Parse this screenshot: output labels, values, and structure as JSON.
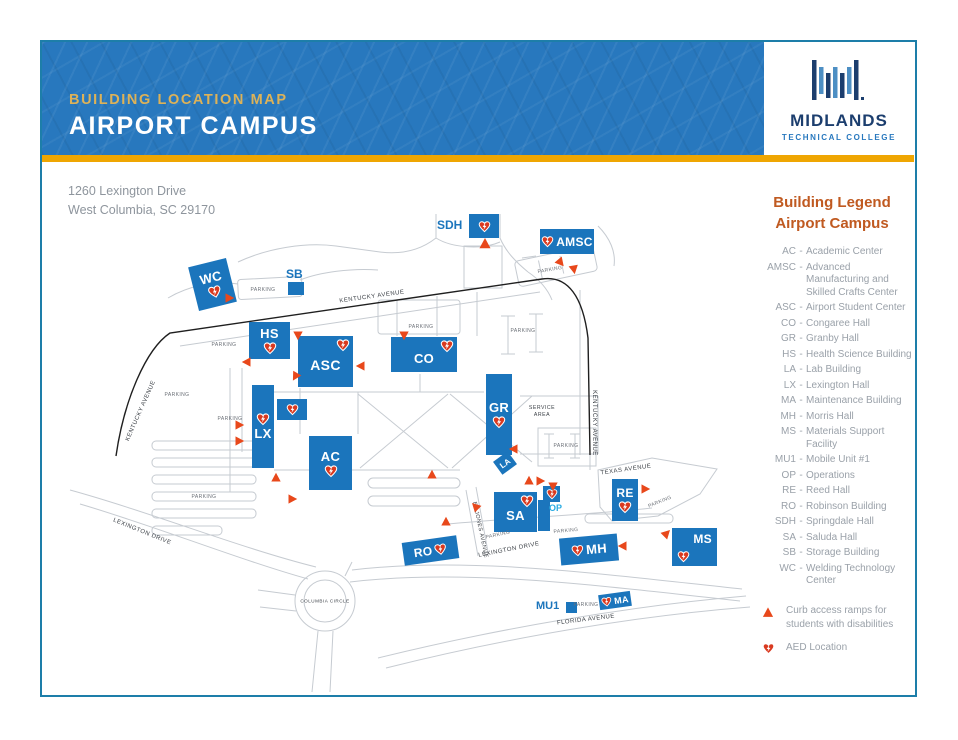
{
  "colors": {
    "header_blue": "#2878BE",
    "gold": "#EFA602",
    "eyebrow_gold": "#DDB258",
    "navy": "#1C3E6E",
    "brand_blue": "#2878BE",
    "building_blue": "#1B75BC",
    "legend_orange": "#C05A21",
    "legend_text_gray": "#9AA1A9",
    "address_gray": "#8E959D",
    "heart_red": "#D93A20",
    "ramp_orange": "#E8481B",
    "op_label_blue": "#29ABE2",
    "border_teal": "#1D7EA9",
    "road_gray": "#C6CBD1",
    "road_black": "#1F1F1F"
  },
  "header": {
    "eyebrow": "BUILDING LOCATION MAP",
    "title": "AIRPORT CAMPUS"
  },
  "brand": {
    "name": "MIDLANDS",
    "tagline": "TECHNICAL COLLEGE"
  },
  "address": {
    "line1": "1260 Lexington Drive",
    "line2": "West Columbia, SC 29170"
  },
  "legend": {
    "title_line1": "Building Legend",
    "title_line2": "Airport Campus",
    "separator": "-",
    "entries": [
      {
        "abbr": "AC",
        "name": "Academic Center"
      },
      {
        "abbr": "AMSC",
        "name": "Advanced Manufacturing and Skilled Crafts Center"
      },
      {
        "abbr": "ASC",
        "name": "Airport Student Center"
      },
      {
        "abbr": "CO",
        "name": "Congaree Hall"
      },
      {
        "abbr": "GR",
        "name": "Granby Hall"
      },
      {
        "abbr": "HS",
        "name": "Health Science Building"
      },
      {
        "abbr": "LA",
        "name": "Lab Building"
      },
      {
        "abbr": "LX",
        "name": "Lexington Hall"
      },
      {
        "abbr": "MA",
        "name": "Maintenance Building"
      },
      {
        "abbr": "MH",
        "name": "Morris Hall"
      },
      {
        "abbr": "MS",
        "name": "Materials Support Facility"
      },
      {
        "abbr": "MU1",
        "name": "Mobile Unit #1"
      },
      {
        "abbr": "OP",
        "name": "Operations"
      },
      {
        "abbr": "RE",
        "name": "Reed Hall"
      },
      {
        "abbr": "RO",
        "name": "Robinson Building"
      },
      {
        "abbr": "SDH",
        "name": "Springdale Hall"
      },
      {
        "abbr": "SA",
        "name": "Saluda Hall"
      },
      {
        "abbr": "SB",
        "name": "Storage Building"
      },
      {
        "abbr": "WC",
        "name": "Welding Technology Center"
      }
    ],
    "markers": [
      {
        "icon": "ramp-triangle",
        "label": "Curb access ramps for students with disabilities"
      },
      {
        "icon": "aed-heart",
        "label": "AED Location"
      }
    ]
  },
  "map": {
    "buildings": [
      {
        "id": "WC",
        "label": "WC",
        "x": 193,
        "y": 262,
        "w": 39,
        "h": 45,
        "rot": -14,
        "fs": 13,
        "layout": "v-lh"
      },
      {
        "id": "SB",
        "label": "",
        "x": 288,
        "y": 282,
        "w": 16,
        "h": 13,
        "rot": 0,
        "layout": "none"
      },
      {
        "id": "SDH",
        "label": "",
        "x": 469,
        "y": 214,
        "w": 30,
        "h": 24,
        "rot": 0,
        "hs": 13,
        "layout": "heart"
      },
      {
        "id": "AMSC",
        "label": "AMSC",
        "x": 540,
        "y": 229,
        "w": 54,
        "h": 25,
        "rot": 0,
        "fs": 12,
        "hs": 13,
        "layout": "inline-hl"
      },
      {
        "id": "HS",
        "label": "HS",
        "x": 249,
        "y": 322,
        "w": 41,
        "h": 37,
        "rot": 0,
        "fs": 13,
        "layout": "v-lh"
      },
      {
        "id": "ASC",
        "label": "ASC",
        "x": 298,
        "y": 336,
        "w": 55,
        "h": 51,
        "rot": 0,
        "fs": 14,
        "layout": "corner-tr"
      },
      {
        "id": "CO",
        "label": "CO",
        "x": 391,
        "y": 337,
        "w": 66,
        "h": 35,
        "rot": 0,
        "fs": 13,
        "layout": "corner-tr"
      },
      {
        "id": "GR",
        "label": "GR",
        "x": 486,
        "y": 374,
        "w": 26,
        "h": 81,
        "rot": 0,
        "fs": 13,
        "layout": "v-lh"
      },
      {
        "id": "LX",
        "label": "LX",
        "x": 252,
        "y": 385,
        "w": 22,
        "h": 83,
        "rot": 0,
        "fs": 13,
        "layout": "v-hl"
      },
      {
        "id": "LXA",
        "label": "",
        "x": 277,
        "y": 399,
        "w": 30,
        "h": 21,
        "rot": 0,
        "hs": 13,
        "layout": "heart"
      },
      {
        "id": "AC",
        "label": "AC",
        "x": 309,
        "y": 436,
        "w": 43,
        "h": 54,
        "rot": 0,
        "fs": 13,
        "layout": "v-lh"
      },
      {
        "id": "LA",
        "label": "LA",
        "x": 496,
        "y": 455,
        "w": 18,
        "h": 16,
        "rot": -36,
        "fs": 8,
        "layout": "label"
      },
      {
        "id": "SA",
        "label": "SA",
        "x": 494,
        "y": 492,
        "w": 43,
        "h": 40,
        "rot": 0,
        "fs": 13,
        "layout": "corner-tr"
      },
      {
        "id": "SAA",
        "label": "",
        "x": 538,
        "y": 500,
        "w": 12,
        "h": 31,
        "rot": 0,
        "layout": "none"
      },
      {
        "id": "OPB",
        "label": "",
        "x": 543,
        "y": 486,
        "w": 17,
        "h": 16,
        "rot": 0,
        "hs": 12,
        "layout": "heart"
      },
      {
        "id": "RE",
        "label": "RE",
        "x": 612,
        "y": 479,
        "w": 26,
        "h": 42,
        "rot": 0,
        "fs": 12,
        "layout": "v-lh"
      },
      {
        "id": "RO",
        "label": "RO",
        "x": 403,
        "y": 539,
        "w": 55,
        "h": 23,
        "rot": -8,
        "fs": 12,
        "hs": 13,
        "layout": "inline-lh"
      },
      {
        "id": "MH",
        "label": "MH",
        "x": 560,
        "y": 536,
        "w": 58,
        "h": 27,
        "rot": -5,
        "fs": 13,
        "hs": 13,
        "layout": "inline-hl"
      },
      {
        "id": "MS",
        "label": "MS",
        "x": 672,
        "y": 528,
        "w": 45,
        "h": 38,
        "rot": 0,
        "fs": 12,
        "hs": 13,
        "layout": "ms"
      },
      {
        "id": "MA",
        "label": "MA",
        "x": 599,
        "y": 593,
        "w": 32,
        "h": 15,
        "rot": -8,
        "fs": 9,
        "hs": 11,
        "layout": "inline-hl"
      },
      {
        "id": "MU1B",
        "label": "",
        "x": 566,
        "y": 602,
        "w": 11,
        "h": 11,
        "rot": 0,
        "layout": "none"
      }
    ],
    "floating_labels": [
      {
        "text": "SB",
        "x": 286,
        "y": 267,
        "fs": 12,
        "color": "#1B75BC"
      },
      {
        "text": "SDH",
        "x": 437,
        "y": 218,
        "fs": 12,
        "color": "#1B75BC"
      },
      {
        "text": "OP",
        "x": 549,
        "y": 503,
        "fs": 9,
        "color": "#29ABE2"
      },
      {
        "text": "MU1",
        "x": 536,
        "y": 600,
        "fs": 11,
        "color": "#1B75BC"
      }
    ],
    "road_labels": [
      {
        "text": "KENTUCKY AVENUE",
        "x": 372,
        "y": 297,
        "rot": -8,
        "fs": 6
      },
      {
        "text": "KENTUCKY AVENUE",
        "x": 141,
        "y": 411,
        "rot": -66,
        "fs": 6
      },
      {
        "text": "KENTUCKY AVENUE",
        "x": 594,
        "y": 423,
        "rot": 90,
        "fs": 6
      },
      {
        "text": "TEXAS AVENUE",
        "x": 626,
        "y": 470,
        "rot": -8,
        "fs": 6
      },
      {
        "text": "EL JONES AVENUE",
        "x": 480,
        "y": 530,
        "rot": 78,
        "fs": 5.5
      },
      {
        "text": "LEXINGTON DRIVE",
        "x": 142,
        "y": 532,
        "rot": 22,
        "fs": 6
      },
      {
        "text": "LEXINGTON DRIVE",
        "x": 509,
        "y": 550,
        "rot": -11,
        "fs": 6
      },
      {
        "text": "COLUMBIA CIRCLE",
        "x": 325,
        "y": 601,
        "rot": 0,
        "fs": 4.6
      },
      {
        "text": "FLORIDA AVENUE",
        "x": 586,
        "y": 620,
        "rot": -7,
        "fs": 6
      },
      {
        "text": "SERVICE",
        "x": 542,
        "y": 408,
        "rot": 0,
        "fs": 5.2
      },
      {
        "text": "AREA",
        "x": 542,
        "y": 415,
        "rot": 0,
        "fs": 5.2
      }
    ],
    "parking_label_text": "PARKING",
    "parking_labels": [
      {
        "x": 263,
        "y": 290,
        "rot": 0
      },
      {
        "x": 224,
        "y": 345,
        "rot": 0
      },
      {
        "x": 177,
        "y": 395,
        "rot": 0
      },
      {
        "x": 230,
        "y": 419,
        "rot": 0
      },
      {
        "x": 204,
        "y": 497,
        "rot": 0
      },
      {
        "x": 421,
        "y": 327,
        "rot": 0
      },
      {
        "x": 523,
        "y": 331,
        "rot": 0
      },
      {
        "x": 550,
        "y": 270,
        "rot": -10
      },
      {
        "x": 566,
        "y": 446,
        "rot": 0
      },
      {
        "x": 660,
        "y": 502,
        "rot": -22
      },
      {
        "x": 498,
        "y": 535,
        "rot": -12
      },
      {
        "x": 566,
        "y": 531,
        "rot": -5
      },
      {
        "x": 586,
        "y": 605,
        "rot": 0
      }
    ],
    "ramps": [
      {
        "x": 230,
        "y": 298,
        "rot": 90
      },
      {
        "x": 485,
        "y": 243,
        "rot": 0,
        "s": 13
      },
      {
        "x": 561,
        "y": 263,
        "rot": 140
      },
      {
        "x": 574,
        "y": 270,
        "rot": 170
      },
      {
        "x": 298,
        "y": 336,
        "rot": 180
      },
      {
        "x": 404,
        "y": 336,
        "rot": 180
      },
      {
        "x": 246,
        "y": 362,
        "rot": 270
      },
      {
        "x": 295,
        "y": 377,
        "rot": 210
      },
      {
        "x": 360,
        "y": 366,
        "rot": 270
      },
      {
        "x": 240,
        "y": 425,
        "rot": 90
      },
      {
        "x": 240,
        "y": 441,
        "rot": 90
      },
      {
        "x": 276,
        "y": 477,
        "rot": 0
      },
      {
        "x": 293,
        "y": 499,
        "rot": 90
      },
      {
        "x": 432,
        "y": 474,
        "rot": 0
      },
      {
        "x": 513,
        "y": 449,
        "rot": 270
      },
      {
        "x": 529,
        "y": 480,
        "rot": 0
      },
      {
        "x": 541,
        "y": 481,
        "rot": 90
      },
      {
        "x": 553,
        "y": 487,
        "rot": 180
      },
      {
        "x": 475,
        "y": 506,
        "rot": 315
      },
      {
        "x": 446,
        "y": 521,
        "rot": 0
      },
      {
        "x": 622,
        "y": 546,
        "rot": 270
      },
      {
        "x": 667,
        "y": 533,
        "rot": 45
      },
      {
        "x": 646,
        "y": 489,
        "rot": 90
      }
    ]
  }
}
